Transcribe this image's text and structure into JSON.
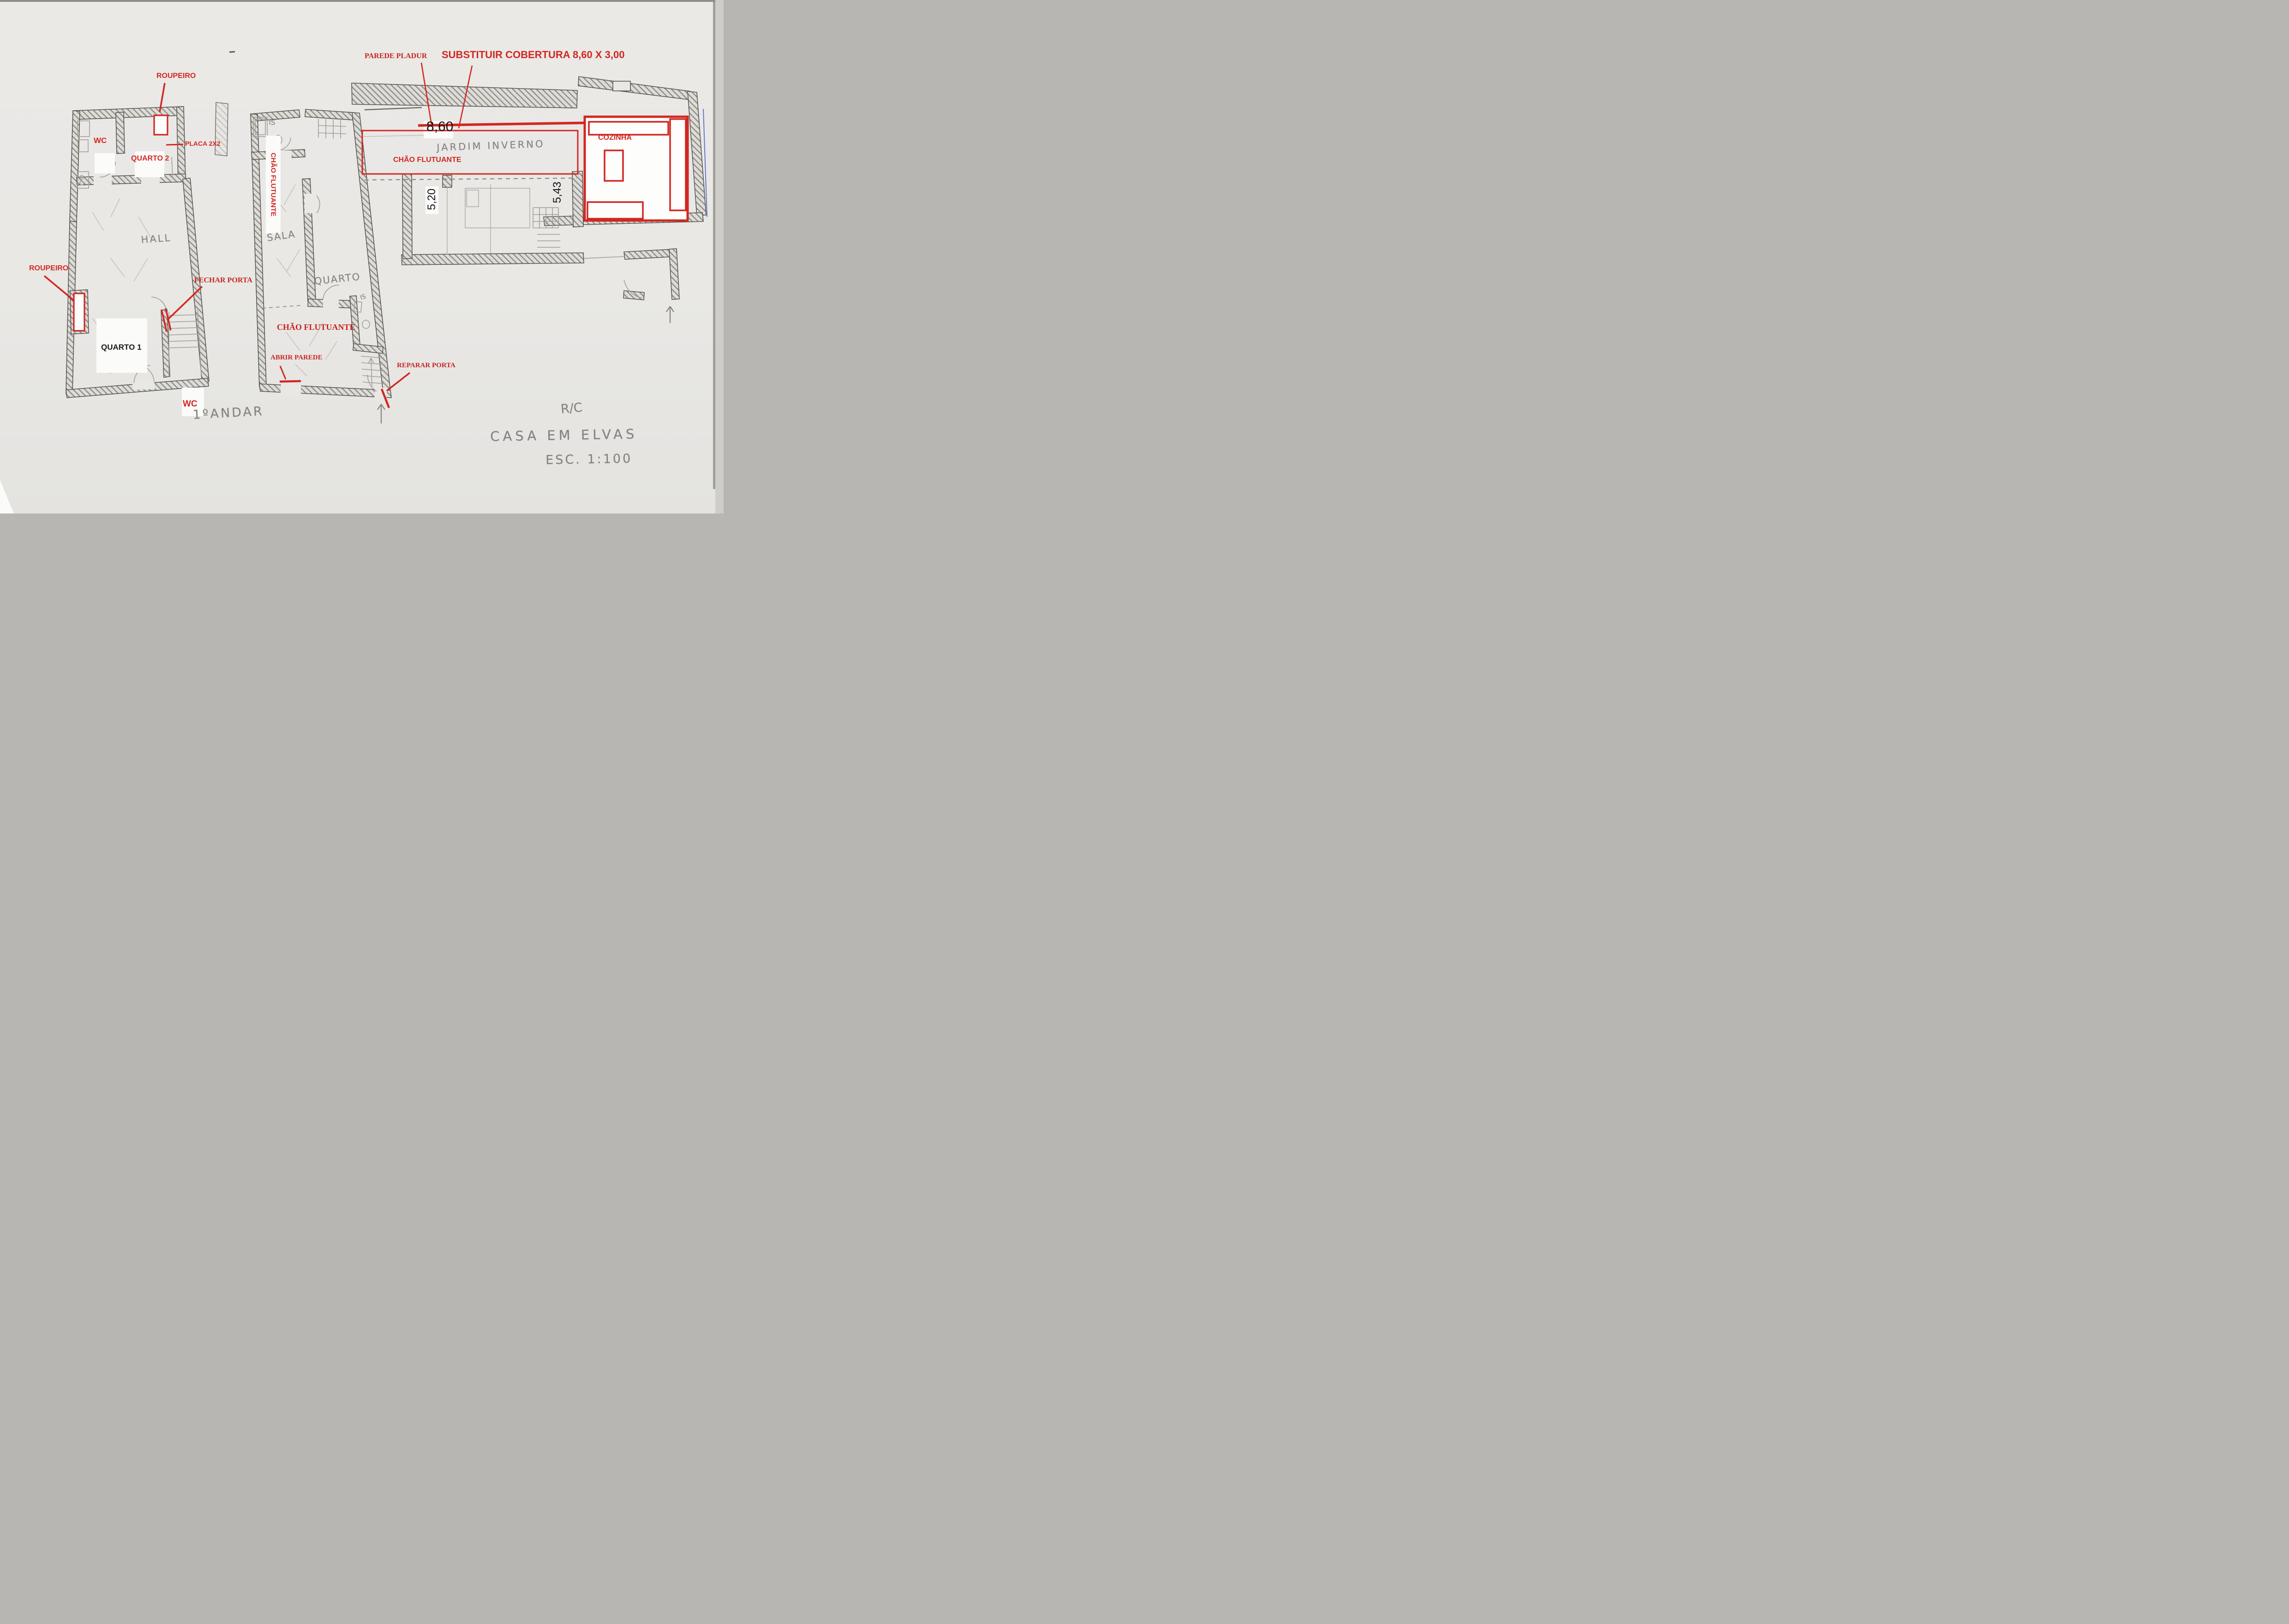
{
  "colors": {
    "annotation_red": "#d22722",
    "pencil_gray": "#85837f",
    "paper": "#e9e8e5",
    "blue_pen": "#4f63c2"
  },
  "floor1": {
    "title": "1ºANDAR",
    "labels": {
      "roupeiro_top": "ROUPEIRO",
      "placa": "PLACA 2X2",
      "wc_top": "WC",
      "quarto2": "QUARTO 2",
      "roupeiro_left": "ROUPEIRO",
      "hall": "HALL",
      "fechar_porta": "FECHAR PORTA",
      "quarto1": "QUARTO 1",
      "wc_bottom": "WC"
    }
  },
  "ground": {
    "labels": {
      "parede_pladur": "PAREDE PLADUR",
      "substituir": "SUBSTITUIR COBERTURA 8,60 X 3,00",
      "is_top": "IS",
      "chao_flutuante_sala": "CHÃO FLUTUANTE",
      "sala": "SALA",
      "quarto": "QUARTO",
      "is_mid": "IS",
      "jardim_inverno": "JARDIM INVERNO",
      "chao_flutuante_jardim": "CHÃO FLUTUANTE",
      "cozinha": "COZINHA",
      "chao_flutuante_bottom": "CHÃO FLUTUANTE",
      "abrir_parede": "ABRIR PAREDE",
      "reparar_porta": "REPARAR PORTA"
    },
    "dimensions": {
      "cobertura_width": "8,60",
      "sala_depth": "5,20",
      "quarto_depth": "5,43"
    }
  },
  "titleblock": {
    "floor": "R/C",
    "project": "CASA EM ELVAS",
    "scale": "ESC. 1:100"
  }
}
